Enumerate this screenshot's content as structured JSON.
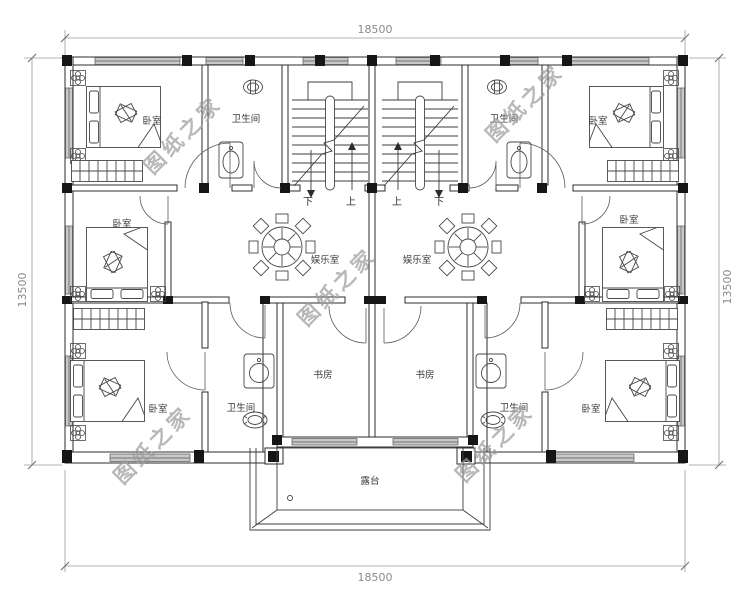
{
  "watermark": {
    "text": "图纸之家"
  },
  "dimensions": {
    "top": "18500",
    "bottom": "18500",
    "left": "13500",
    "right": "13500"
  },
  "stair_labels": {
    "left_down": "下",
    "left_up": "上",
    "right_up": "上",
    "right_down": "下"
  },
  "rooms": {
    "bedroom_top_left": "卧室",
    "bathroom_top_left": "卫生间",
    "bathroom_top_right": "卫生间",
    "bedroom_top_right": "卧室",
    "bedroom_mid_left": "卧室",
    "recreation_left": "娱乐室",
    "recreation_right": "娱乐室",
    "bedroom_mid_right": "卧室",
    "bedroom_bottom_left": "卧室",
    "bathroom_bottom_left": "卫生间",
    "study_left": "书房",
    "study_right": "书房",
    "bathroom_bottom_right": "卫生间",
    "bedroom_bottom_right": "卧室",
    "terrace": "露台"
  },
  "colors": {
    "line": "#2d2d2d",
    "window_fill": "#c9c9c9",
    "column": "#161616",
    "dimension_text": "#8a8a8a",
    "watermark": "#9d9d9d",
    "background": "#ffffff"
  }
}
